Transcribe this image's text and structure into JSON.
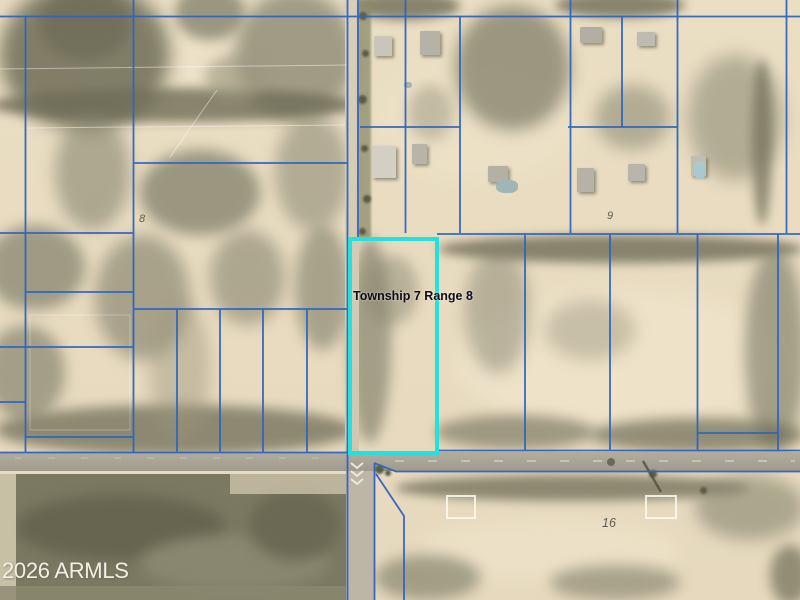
{
  "map": {
    "township_label": "Township 7 Range 8",
    "section_labels": [
      {
        "text": "8"
      },
      {
        "text": "9"
      },
      {
        "text": "16"
      }
    ],
    "watermark": "2026 ARMLS"
  },
  "colors": {
    "parcel_line": "#2e63bd",
    "highlight_border": "#27e0de",
    "township_label_text": "#0d0d18",
    "section_label_text": "#5f5d4d",
    "watermark_text": "#f2efe6",
    "terrain_base": "#e8dbbf",
    "road_surface": "#aaa497"
  }
}
